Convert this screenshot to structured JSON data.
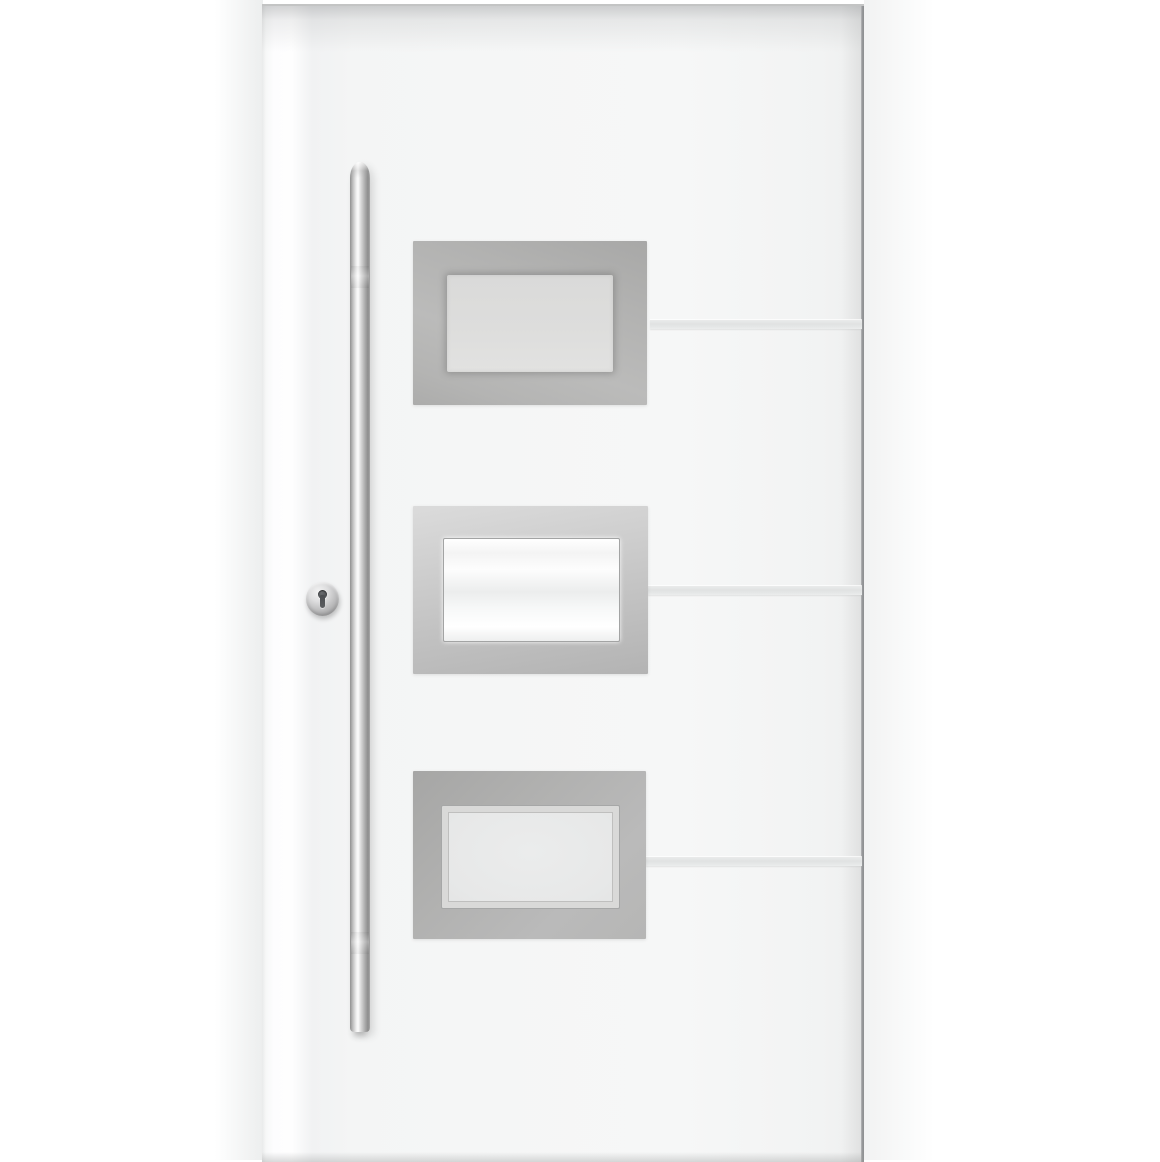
{
  "image_type": "product-photo",
  "subject": {
    "description": "Modern white aluminium entry door shown in front elevation on a white studio background, with a long vertical stainless-steel bar pull handle on the left, a round stainless lock cylinder escutcheon with keyhole, three stainless-steel framed frosted glass panels stacked vertically in the centre, and three horizontal aluminium inlay strips running from each panel to the right edge of the leaf"
  },
  "elements": {
    "pull_handle": {
      "name": "vertical stainless-steel bar pull handle"
    },
    "lock_cylinder": {
      "name": "round stainless escutcheon with dark keyhole"
    },
    "glass_panels": [
      {
        "name": "top glass panel",
        "glass": "frosted grey glass in brushed steel frame"
      },
      {
        "name": "middle glass panel",
        "glass": "bright frosted white glass in brushed steel frame"
      },
      {
        "name": "bottom glass panel",
        "glass": "frosted grey glass with inner glazing bead in brushed steel frame"
      }
    ],
    "inlay_strips": [
      {
        "name": "top aluminium inlay strip"
      },
      {
        "name": "middle aluminium inlay strip"
      },
      {
        "name": "bottom aluminium inlay strip"
      }
    ]
  },
  "colors": {
    "bg": "#ffffff",
    "door-face": "#f5f6f6",
    "door-stile-highlight": "#fdfdfe",
    "door-edge-line": "#97999b",
    "panel-frame": "#b4b4b3",
    "panel-frame-light": "#d8d8d8",
    "glass-grey": "#e7e8e8",
    "glass-white": "#fbfbfb",
    "strip": "#e0e2e2",
    "steel-highlight": "#fdfdfd",
    "steel-shadow": "#8c8c8c",
    "keyhole": "#4b4d50"
  }
}
